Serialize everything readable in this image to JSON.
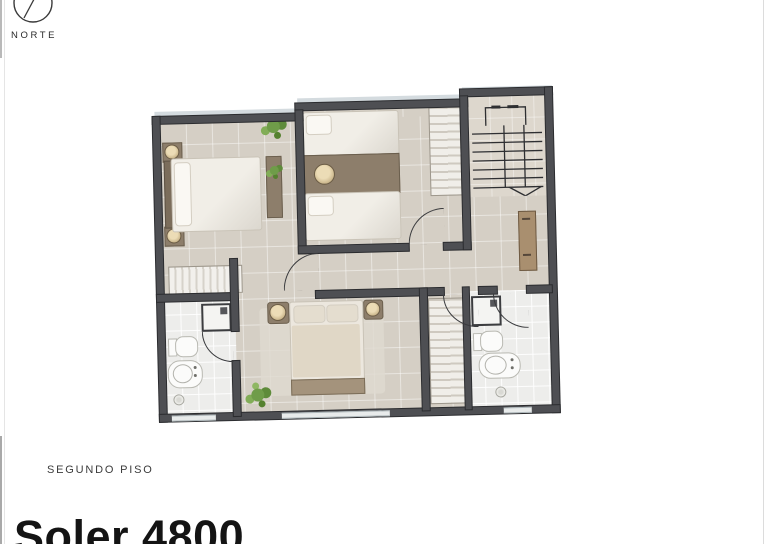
{
  "labels": {
    "north": "NORTE",
    "floor": "SEGUNDO PISO",
    "title": "Soler 4800"
  },
  "palette": {
    "wall": "#4e4f53",
    "floor": "#d5cfc5",
    "bath": "#ededeb",
    "wood": "#8d7e6b",
    "linen": "#f1eee7",
    "plant": "#6f9c49",
    "glass": "#ccd5d9",
    "ink": "#2a2a2a"
  }
}
